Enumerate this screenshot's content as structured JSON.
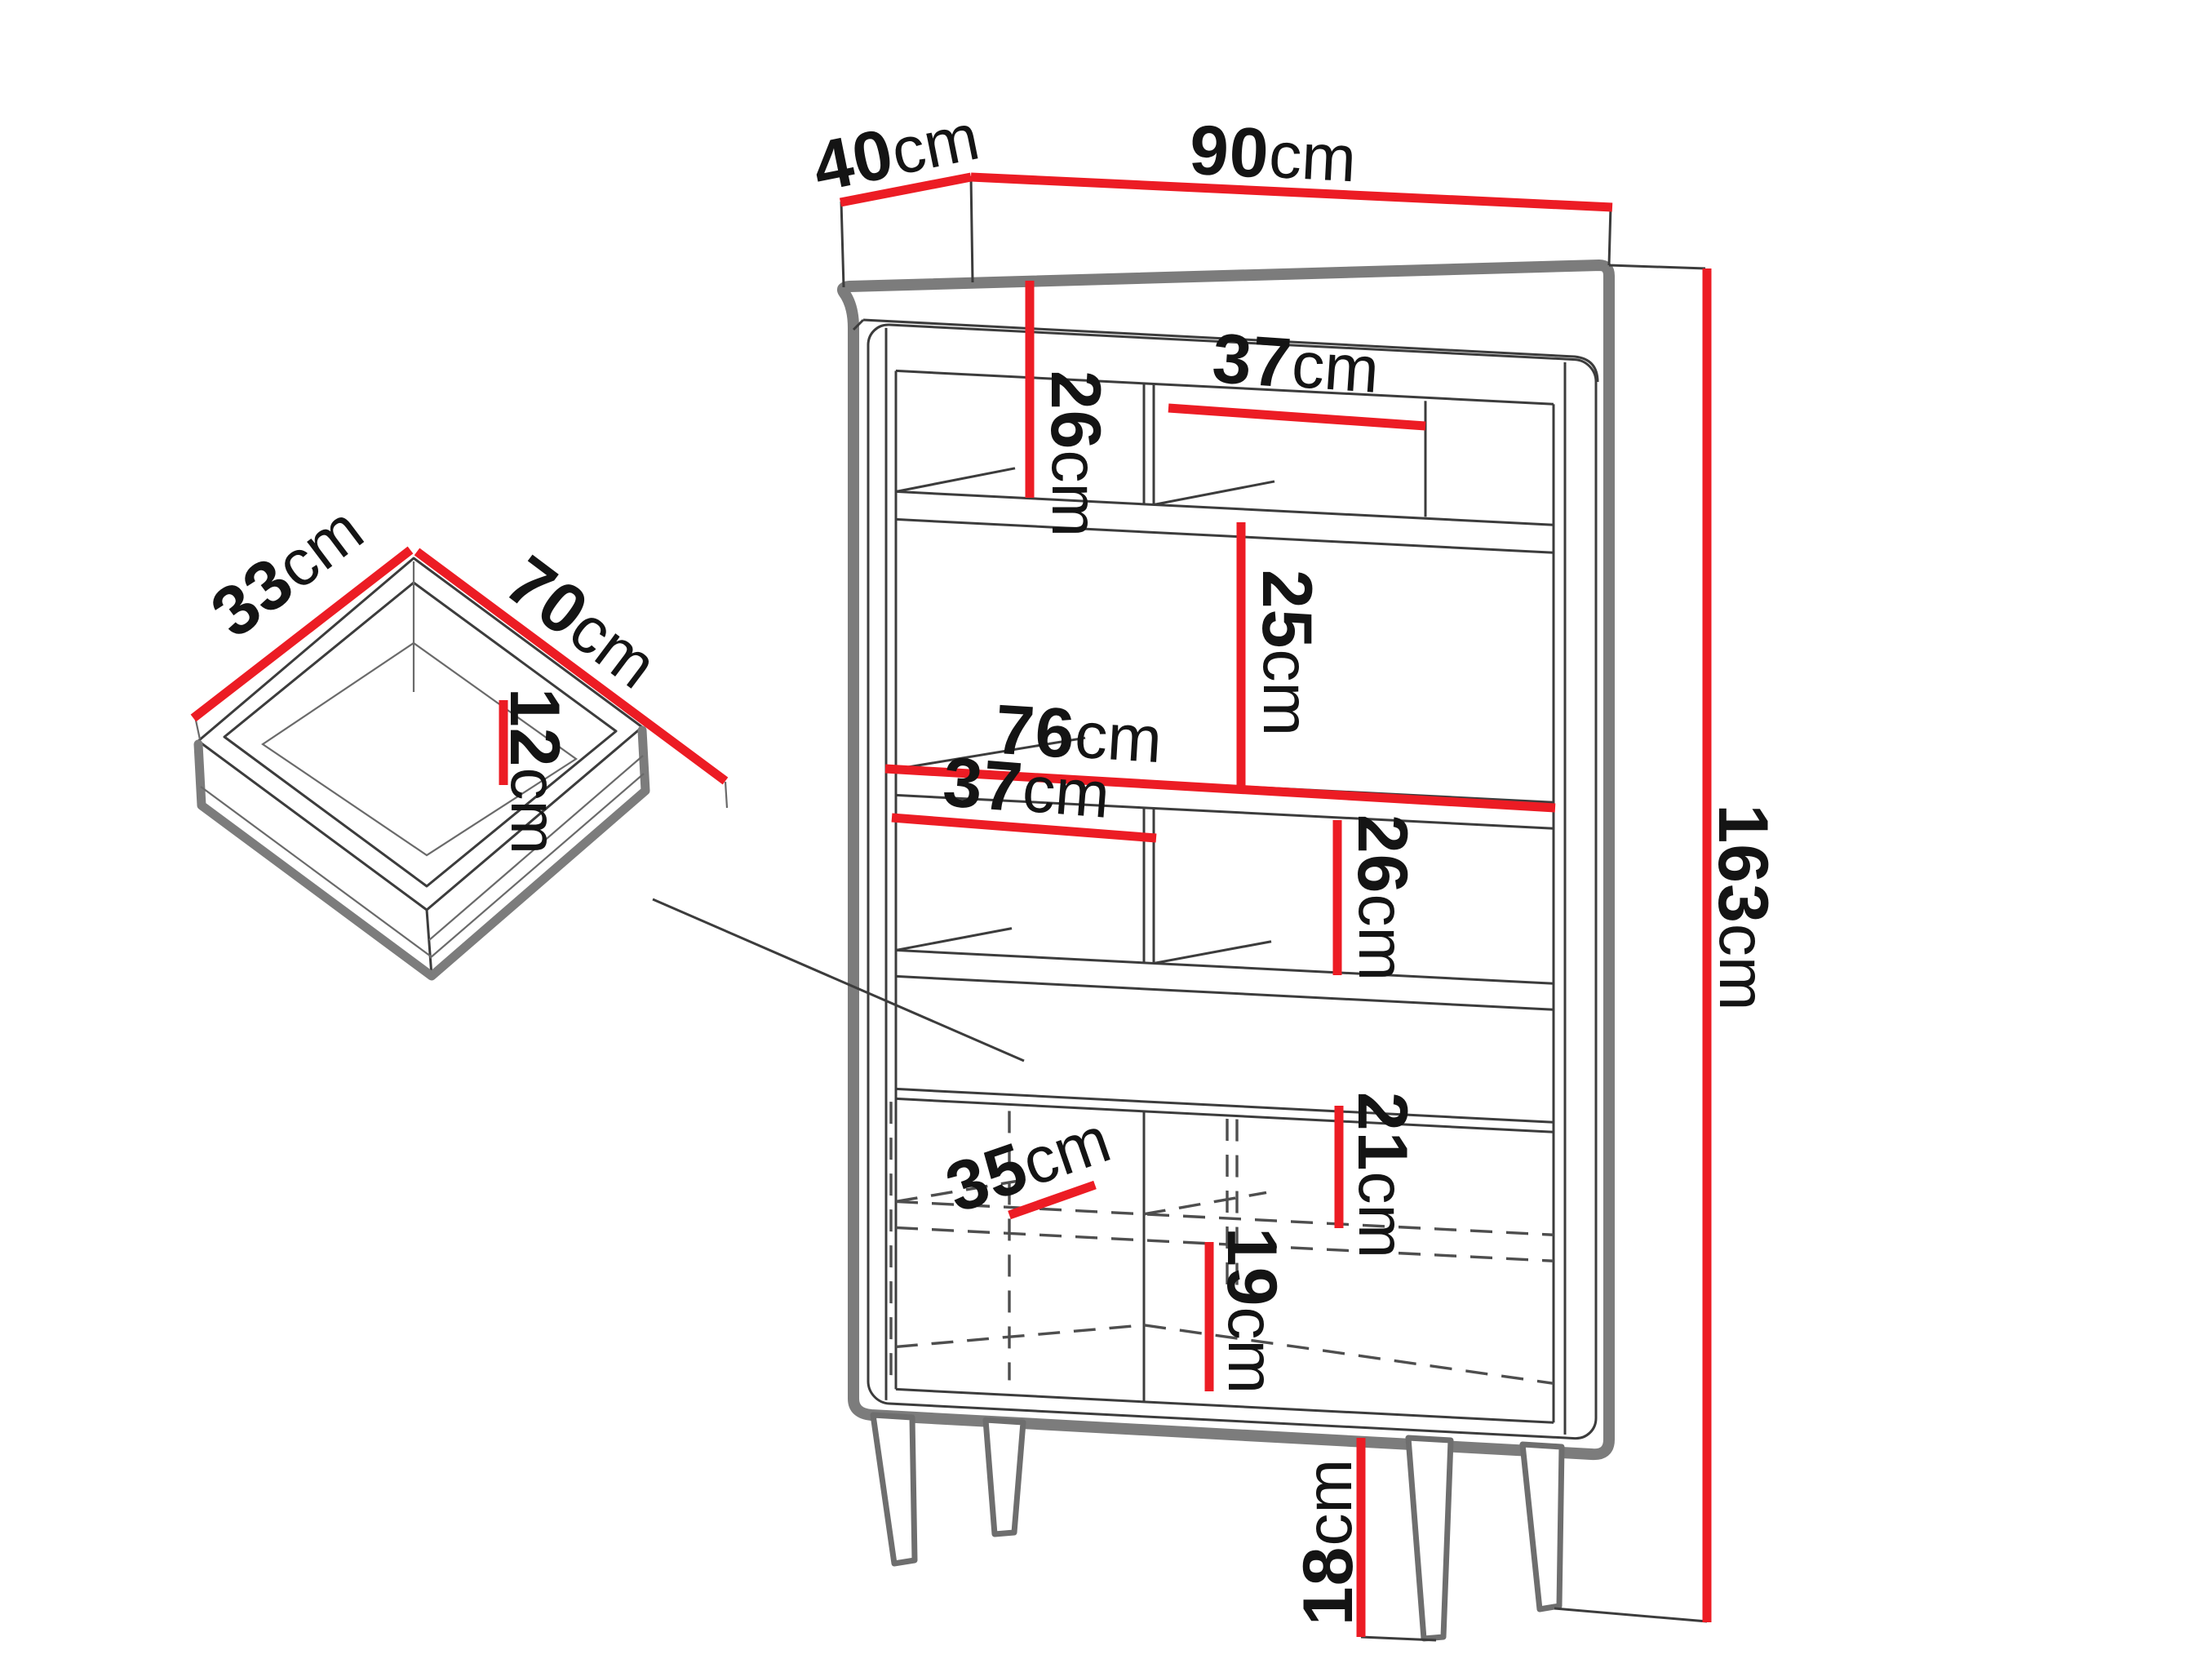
{
  "diagram_type": "furniture-dimension-drawing",
  "colors": {
    "dimension_red": "#ec1c24",
    "outline_gray": "#7c7c7c",
    "line_dark": "#3c3c3c",
    "text": "#141414",
    "background": "#ffffff"
  },
  "cabinet": {
    "depth": {
      "value": "40",
      "unit": "cm"
    },
    "width": {
      "value": "90",
      "unit": "cm"
    },
    "height": {
      "value": "163",
      "unit": "cm"
    },
    "top_left_cell_height": {
      "value": "26",
      "unit": "cm"
    },
    "top_right_cell_width": {
      "value": "37",
      "unit": "cm"
    },
    "middle_cell_height": {
      "value": "25",
      "unit": "cm"
    },
    "interior_width": {
      "value": "76",
      "unit": "cm"
    },
    "lower_left_cell_width": {
      "value": "37",
      "unit": "cm"
    },
    "lower_right_cell_height": {
      "value": "26",
      "unit": "cm"
    },
    "upper_door_cell_height": {
      "value": "21",
      "unit": "cm"
    },
    "door_shelf_depth": {
      "value": "35",
      "unit": "cm"
    },
    "lower_door_cell_height": {
      "value": "19",
      "unit": "cm"
    },
    "leg_height": {
      "value": "18",
      "unit": "cm"
    }
  },
  "drawer": {
    "depth": {
      "value": "33",
      "unit": "cm"
    },
    "width": {
      "value": "70",
      "unit": "cm"
    },
    "height": {
      "value": "12",
      "unit": "cm"
    }
  }
}
